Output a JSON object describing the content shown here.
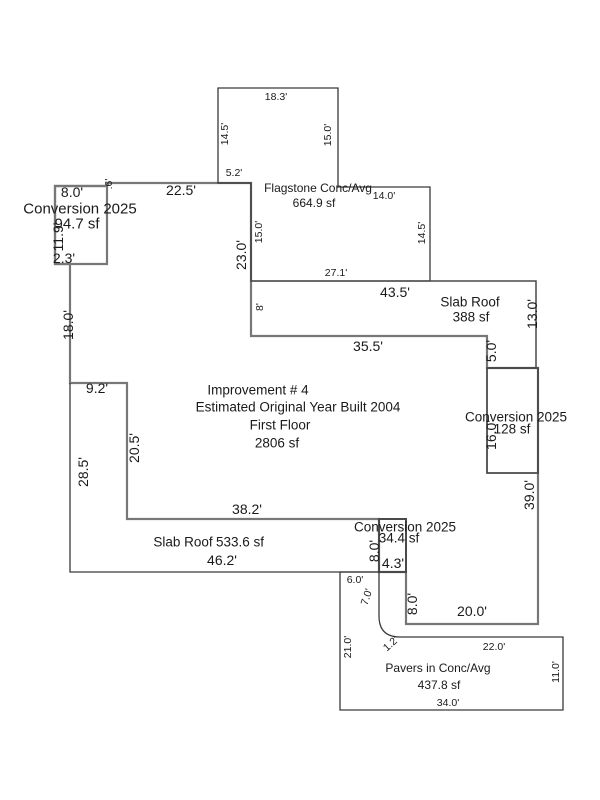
{
  "sketch": {
    "width": 600,
    "height": 800,
    "background": "#ffffff",
    "palette": {
      "main_outline": "#777777",
      "area_outline": "#3a3a3a",
      "box_outline": "#4a4a4a",
      "text": "#1a1a1a"
    },
    "shapes": [
      {
        "name": "main-building-outline",
        "path": "M107,183 L251,183 L251,336 L487,336 L487,368 L538,368 L538,624 L406,624 L406,572 L379,572 L379,519 L127,519 L127,383 L70,383 L70,264 L55,264 L55,186 L107,186 Z",
        "stroke": "#777777",
        "width": 2.2
      },
      {
        "name": "conversion-94-outline",
        "path": "M55,186 L107,186 L107,264 L55,264 Z",
        "stroke": "#777777",
        "width": 2.2
      },
      {
        "name": "flagstone-outline",
        "path": "M218,88 L338,88 L338,187 L430,187 L430,281 L251,281 L251,183 L218,183 Z",
        "stroke": "#3a3a3a",
        "width": 1.3
      },
      {
        "name": "slab-roof-388-outline",
        "path": "M251,281 L536,281 L536,368 L487,368",
        "stroke": "#4a4a4a",
        "width": 1.5
      },
      {
        "name": "conversion-128-outline",
        "path": "M487,368 L538,368 L538,473 L487,473 Z",
        "stroke": "#4a4a4a",
        "width": 1.8
      },
      {
        "name": "slab-roof-533-outline",
        "path": "M70,383 L70,572 L379,572",
        "stroke": "#3a3a3a",
        "width": 1.3
      },
      {
        "name": "conversion-34-outline",
        "path": "M379,519 L406,519 L406,572 L379,572 Z",
        "stroke": "#4a4a4a",
        "width": 2
      },
      {
        "name": "pavers-outline",
        "path": "M340,572 L379,572 L379,616 Q379,637 400,637 L563,637 L563,710 L340,710 Z",
        "stroke": "#3a3a3a",
        "width": 1.3
      }
    ],
    "labels": [
      {
        "name": "label-conversion-topleft",
        "text": "Conversion 2025",
        "x": 80,
        "y": 209,
        "rot": 0,
        "size": 15
      },
      {
        "name": "label-conversion-topleft-area",
        "text": "94.7 sf",
        "x": 77,
        "y": 224,
        "rot": 0,
        "size": 15
      },
      {
        "name": "dim-topleft-box-top",
        "text": "8.0'",
        "x": 72,
        "y": 192,
        "rot": 0,
        "size": 14
      },
      {
        "name": "dim-topleft-box-left",
        "text": "11.9'",
        "x": 58,
        "y": 237,
        "rot": -90,
        "size": 14
      },
      {
        "name": "dim-topleft-box-bottom",
        "text": "2.3'",
        "x": 64,
        "y": 258,
        "rot": 0,
        "size": 14
      },
      {
        "name": "dim-topleft-step",
        "text": ".6'",
        "x": 109,
        "y": 184,
        "rot": -90,
        "size": 10.5
      },
      {
        "name": "dim-main-top",
        "text": "22.5'",
        "x": 181,
        "y": 190,
        "rot": 0,
        "size": 14
      },
      {
        "name": "dim-flagstone-notch",
        "text": "5.2'",
        "x": 234,
        "y": 173,
        "rot": 0,
        "size": 10.5
      },
      {
        "name": "dim-flagstone-top",
        "text": "18.3'",
        "x": 276,
        "y": 97,
        "rot": 0,
        "size": 10.5
      },
      {
        "name": "dim-flagstone-upper-left",
        "text": "14.5'",
        "x": 225,
        "y": 134,
        "rot": -90,
        "size": 10.5
      },
      {
        "name": "dim-flagstone-upper-right",
        "text": "15.0'",
        "x": 328,
        "y": 135,
        "rot": -90,
        "size": 10.5
      },
      {
        "name": "label-flagstone",
        "text": "Flagstone Conc/Avg",
        "x": 318,
        "y": 188,
        "rot": 0,
        "size": 12
      },
      {
        "name": "label-flagstone-area",
        "text": "664.9 sf",
        "x": 314,
        "y": 203,
        "rot": 0,
        "size": 12
      },
      {
        "name": "dim-flagstone-mid-top",
        "text": "14.0'",
        "x": 384,
        "y": 196,
        "rot": 0,
        "size": 10.5
      },
      {
        "name": "dim-flagstone-lower-left",
        "text": "15.0'",
        "x": 259,
        "y": 232,
        "rot": -90,
        "size": 10.5
      },
      {
        "name": "dim-main-left-upper",
        "text": "23.0'",
        "x": 241,
        "y": 255,
        "rot": -90,
        "size": 14
      },
      {
        "name": "dim-flagstone-lower-right",
        "text": "14.5'",
        "x": 422,
        "y": 233,
        "rot": -90,
        "size": 10.5
      },
      {
        "name": "dim-flagstone-bottom",
        "text": "27.1'",
        "x": 336,
        "y": 273,
        "rot": 0,
        "size": 10.5
      },
      {
        "name": "dim-slab388-top",
        "text": "43.5'",
        "x": 395,
        "y": 292,
        "rot": 0,
        "size": 14
      },
      {
        "name": "dim-slab388-left",
        "text": "8'",
        "x": 260,
        "y": 307,
        "rot": -90,
        "size": 10.5
      },
      {
        "name": "label-slab388",
        "text": "Slab Roof",
        "x": 470,
        "y": 302,
        "rot": 0,
        "size": 13.5
      },
      {
        "name": "label-slab388-area",
        "text": "388 sf",
        "x": 471,
        "y": 317,
        "rot": 0,
        "size": 13.5
      },
      {
        "name": "dim-slab388-right",
        "text": "13.0'",
        "x": 532,
        "y": 314,
        "rot": -90,
        "size": 14
      },
      {
        "name": "dim-main-top-right",
        "text": "35.5'",
        "x": 368,
        "y": 346,
        "rot": 0,
        "size": 14
      },
      {
        "name": "dim-main-step-right",
        "text": "5.0'",
        "x": 491,
        "y": 351,
        "rot": -90,
        "size": 14
      },
      {
        "name": "label-improvement",
        "text": "Improvement # 4",
        "x": 258,
        "y": 390,
        "rot": 0,
        "size": 13.5
      },
      {
        "name": "label-year-built",
        "text": "Estimated Original Year Built 2004",
        "x": 298,
        "y": 407,
        "rot": 0,
        "size": 13.5
      },
      {
        "name": "label-first-floor",
        "text": "First Floor",
        "x": 280,
        "y": 425,
        "rot": 0,
        "size": 13.5
      },
      {
        "name": "label-first-floor-area",
        "text": "2806 sf",
        "x": 277,
        "y": 443,
        "rot": 0,
        "size": 13.5
      },
      {
        "name": "label-conversion-right",
        "text": "Conversion 2025",
        "x": 516,
        "y": 417,
        "rot": 0,
        "size": 13.5
      },
      {
        "name": "label-conversion-right-area",
        "text": "128 sf",
        "x": 512,
        "y": 429,
        "rot": 0,
        "size": 13.5
      },
      {
        "name": "dim-conversion128-left",
        "text": "16.0'",
        "x": 491,
        "y": 435,
        "rot": -90,
        "size": 14
      },
      {
        "name": "dim-main-right",
        "text": "39.0'",
        "x": 529,
        "y": 495,
        "rot": -90,
        "size": 14
      },
      {
        "name": "dim-main-left-mid",
        "text": "18.0'",
        "x": 68,
        "y": 325,
        "rot": -90,
        "size": 14
      },
      {
        "name": "dim-main-step-left",
        "text": "9.2'",
        "x": 97,
        "y": 388,
        "rot": 0,
        "size": 14
      },
      {
        "name": "dim-slab533-left",
        "text": "28.5'",
        "x": 83,
        "y": 472,
        "rot": -90,
        "size": 14
      },
      {
        "name": "dim-main-left-lower",
        "text": "20.5'",
        "x": 134,
        "y": 448,
        "rot": -90,
        "size": 14
      },
      {
        "name": "dim-main-bottom-left",
        "text": "38.2'",
        "x": 247,
        "y": 509,
        "rot": 0,
        "size": 14
      },
      {
        "name": "label-slab533",
        "text": "Slab Roof",
        "x": 183,
        "y": 542,
        "rot": 0,
        "size": 13.5
      },
      {
        "name": "label-slab533-area",
        "text": "533.6 sf",
        "x": 240,
        "y": 542,
        "rot": 0,
        "size": 13.5
      },
      {
        "name": "dim-slab533-bottom",
        "text": "46.2'",
        "x": 222,
        "y": 560,
        "rot": 0,
        "size": 14
      },
      {
        "name": "label-conversion-bottom",
        "text": "Conversion 2025",
        "x": 405,
        "y": 527,
        "rot": 0,
        "size": 13.5
      },
      {
        "name": "label-conversion-bottom-area",
        "text": "34.4 sf",
        "x": 399,
        "y": 538,
        "rot": 0,
        "size": 13.5
      },
      {
        "name": "dim-conversion34-left",
        "text": "8.0'",
        "x": 374,
        "y": 551,
        "rot": -90,
        "size": 14
      },
      {
        "name": "dim-conversion34-bottom",
        "text": "4.3'",
        "x": 393,
        "y": 563,
        "rot": 0,
        "size": 14
      },
      {
        "name": "dim-pavers-top-notch",
        "text": "6.0'",
        "x": 355,
        "y": 580,
        "rot": 0,
        "size": 10.5
      },
      {
        "name": "dim-pavers-upper-left",
        "text": "7.0'",
        "x": 367,
        "y": 597,
        "rot": -72,
        "size": 10.5
      },
      {
        "name": "dim-main-bottom-step",
        "text": "8.0'",
        "x": 412,
        "y": 604,
        "rot": -90,
        "size": 14
      },
      {
        "name": "dim-main-bottom-right",
        "text": "20.0'",
        "x": 472,
        "y": 611,
        "rot": 0,
        "size": 14
      },
      {
        "name": "dim-pavers-left",
        "text": "21.0'",
        "x": 348,
        "y": 647,
        "rot": -90,
        "size": 10.5
      },
      {
        "name": "dim-pavers-curve",
        "text": "1.2'",
        "x": 391,
        "y": 644,
        "rot": -42,
        "size": 10.5
      },
      {
        "name": "dim-pavers-top",
        "text": "22.0'",
        "x": 494,
        "y": 647,
        "rot": 0,
        "size": 10.5
      },
      {
        "name": "label-pavers",
        "text": "Pavers in Conc/Avg",
        "x": 438,
        "y": 668,
        "rot": 0,
        "size": 12
      },
      {
        "name": "label-pavers-area",
        "text": "437.8 sf",
        "x": 439,
        "y": 685,
        "rot": 0,
        "size": 12
      },
      {
        "name": "dim-pavers-bottom",
        "text": "34.0'",
        "x": 448,
        "y": 703,
        "rot": 0,
        "size": 10.5
      },
      {
        "name": "dim-pavers-right",
        "text": "11.0'",
        "x": 556,
        "y": 672,
        "rot": -90,
        "size": 10.5
      }
    ]
  }
}
